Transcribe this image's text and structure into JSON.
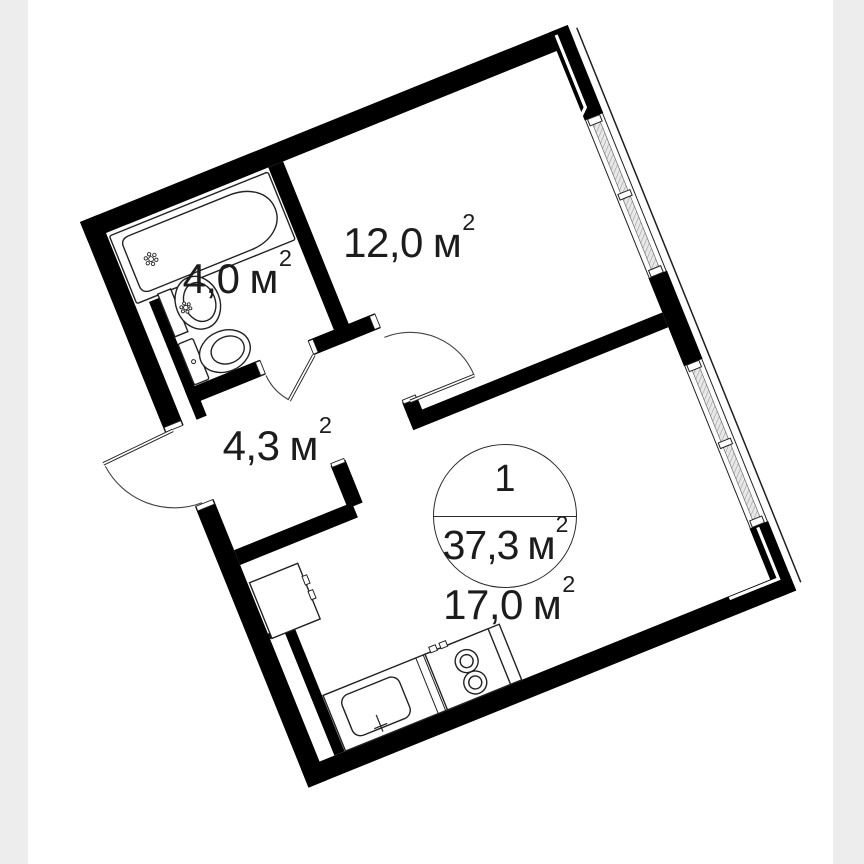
{
  "plan_title": "apartment floor plan",
  "summary": {
    "rooms": "1",
    "total_area": "37,3",
    "unit": "м",
    "sup": "2"
  },
  "labels": {
    "bathroom": {
      "area": "4,0",
      "unit": "м",
      "sup": "2"
    },
    "bedroom": {
      "area": "12,0",
      "unit": "м",
      "sup": "2"
    },
    "hallway": {
      "area": "4,3",
      "unit": "м",
      "sup": "2"
    },
    "kitchen_living": {
      "area": "17,0",
      "unit": "м",
      "sup": "2"
    }
  },
  "icons": [
    "bathtub-icon",
    "washbasin-icon",
    "toilet-icon",
    "fridge-icon",
    "kitchen-sink-icon",
    "stove-icon",
    "window-icon",
    "door-arc-icon"
  ],
  "colors": {
    "background": "#ffffff",
    "side_band": "#ededed",
    "wall": "#000000",
    "thin_line": "#222222",
    "text": "#1c1c1c",
    "window_glazing": "#e8e8e8"
  }
}
